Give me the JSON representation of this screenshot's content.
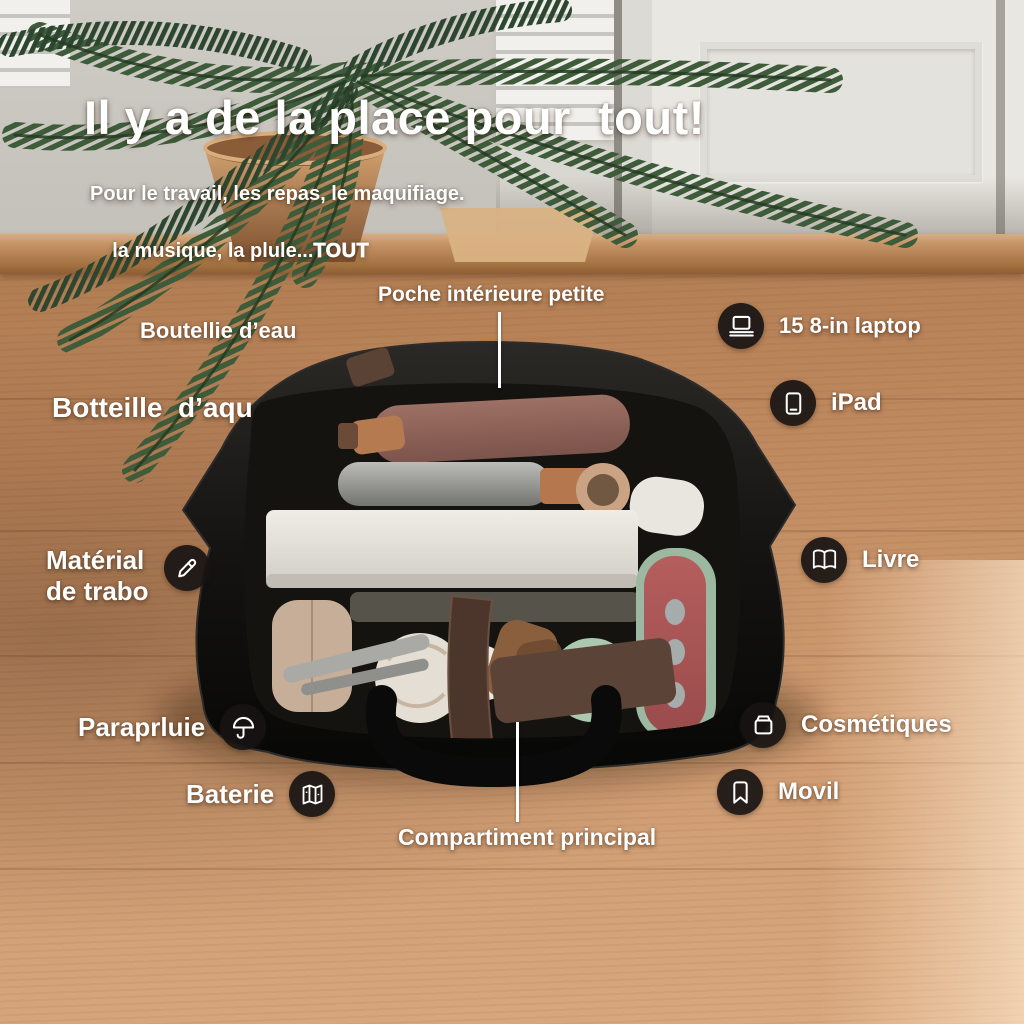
{
  "headline": {
    "title": "Il y a de la place pour  tout!",
    "subtitle_line1": "Pour le travail, les repas, le maquifiage.",
    "subtitle_line2": "la musique, la plule...",
    "subtitle_emphasis": "TOUT"
  },
  "callouts": {
    "top_pocket": {
      "label": "Poche intérieure petite"
    },
    "bottom_compartment": {
      "label": "Compartiment principal"
    },
    "left": [
      {
        "id": "water-bottle-small",
        "label": "Boutellie d’eau",
        "icon": null
      },
      {
        "id": "water-bottle-large",
        "label": "Botteille  d’aqu",
        "icon": null
      },
      {
        "id": "work-material",
        "label_line1": "Matérial",
        "label_line2": "de trabo",
        "icon": "pencil-icon"
      },
      {
        "id": "umbrella",
        "label": "Paraprluie",
        "icon": "umbrella-icon"
      },
      {
        "id": "battery",
        "label": "Baterie",
        "icon": "map-icon"
      }
    ],
    "right": [
      {
        "id": "laptop",
        "label": "15 8-in laptop",
        "icon": "laptop-icon"
      },
      {
        "id": "ipad",
        "label": "iPad",
        "icon": "tablet-icon"
      },
      {
        "id": "book",
        "label": "Livre",
        "icon": "book-icon"
      },
      {
        "id": "cosmetics",
        "label": "Cosmétiques",
        "icon": "compact-icon"
      },
      {
        "id": "mobile",
        "label": "Movil",
        "icon": "bookmark-icon"
      }
    ]
  },
  "colors": {
    "wood_light": "#d9a87e",
    "wood_mid": "#b5805a",
    "wood_dark": "#8a5a38",
    "cabinet_white": "#e8e6e1",
    "leaf_green": "#3e5c3a",
    "terracotta": "#c3915f",
    "bag_black": "#131210",
    "accent_red": "#a85454",
    "accent_mint": "#abc9b0",
    "label_white": "#ffffff",
    "badge_bg": "#171412"
  }
}
